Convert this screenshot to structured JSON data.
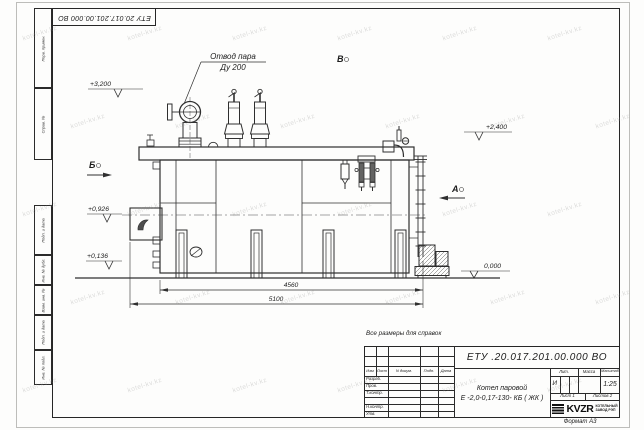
{
  "watermark": "kotel-kv.kz",
  "sheet": {
    "top_stamp": "ЕТУ 20.017.201.00.000  ВО",
    "format_label": "Формат А3",
    "note": "Все размеры для справок",
    "margin_labels": {
      "perv": "Перв. примен.",
      "sprav": "Справ. №",
      "podp1": "Подп. и дата",
      "inv_dubl": "Инв. № дубл.",
      "vzam": "Взам. инв. №",
      "podp2": "Подп. и дата",
      "inv_podl": "Инв. № подл."
    }
  },
  "drawing": {
    "callout_line1": "Отвод пара",
    "callout_line2": "Ду 200",
    "elev_top": "+3,200",
    "elev_right": "+2,400",
    "elev_burner": "+0,926",
    "elev_low": "+0,136",
    "elev_ground": "0,000",
    "view_b": "Б",
    "view_v": "В",
    "view_a": "А",
    "dim_body": "4560",
    "dim_overall": "5100"
  },
  "title_block": {
    "doc_number": "ЕТУ .20.017.201.00.000  ВО",
    "name_line1": "Котел паровой",
    "name_line2": "Е -2,0-0,17-130- КБ ( ЖК )",
    "header": {
      "izm": "Изм",
      "list": "Лист",
      "ndoc": "N докум.",
      "podp": "Подп.",
      "data": "Дата"
    },
    "rows": [
      "Разраб.",
      "Пров.",
      "Т.контр.",
      "",
      "Н.контр.",
      "Утв."
    ],
    "lit_label": "Лит.",
    "lit_value": "И",
    "massa_label": "Масса",
    "masshtab_label": "Масштаб",
    "scale_value": "1:25",
    "list_label": "Лист 1",
    "listov_label": "Листов 2",
    "logo_text": "KVZR",
    "logo_caption1": "КОТЕЛЬНЫЙ",
    "logo_caption2": "ЗАВОД РЭП"
  }
}
